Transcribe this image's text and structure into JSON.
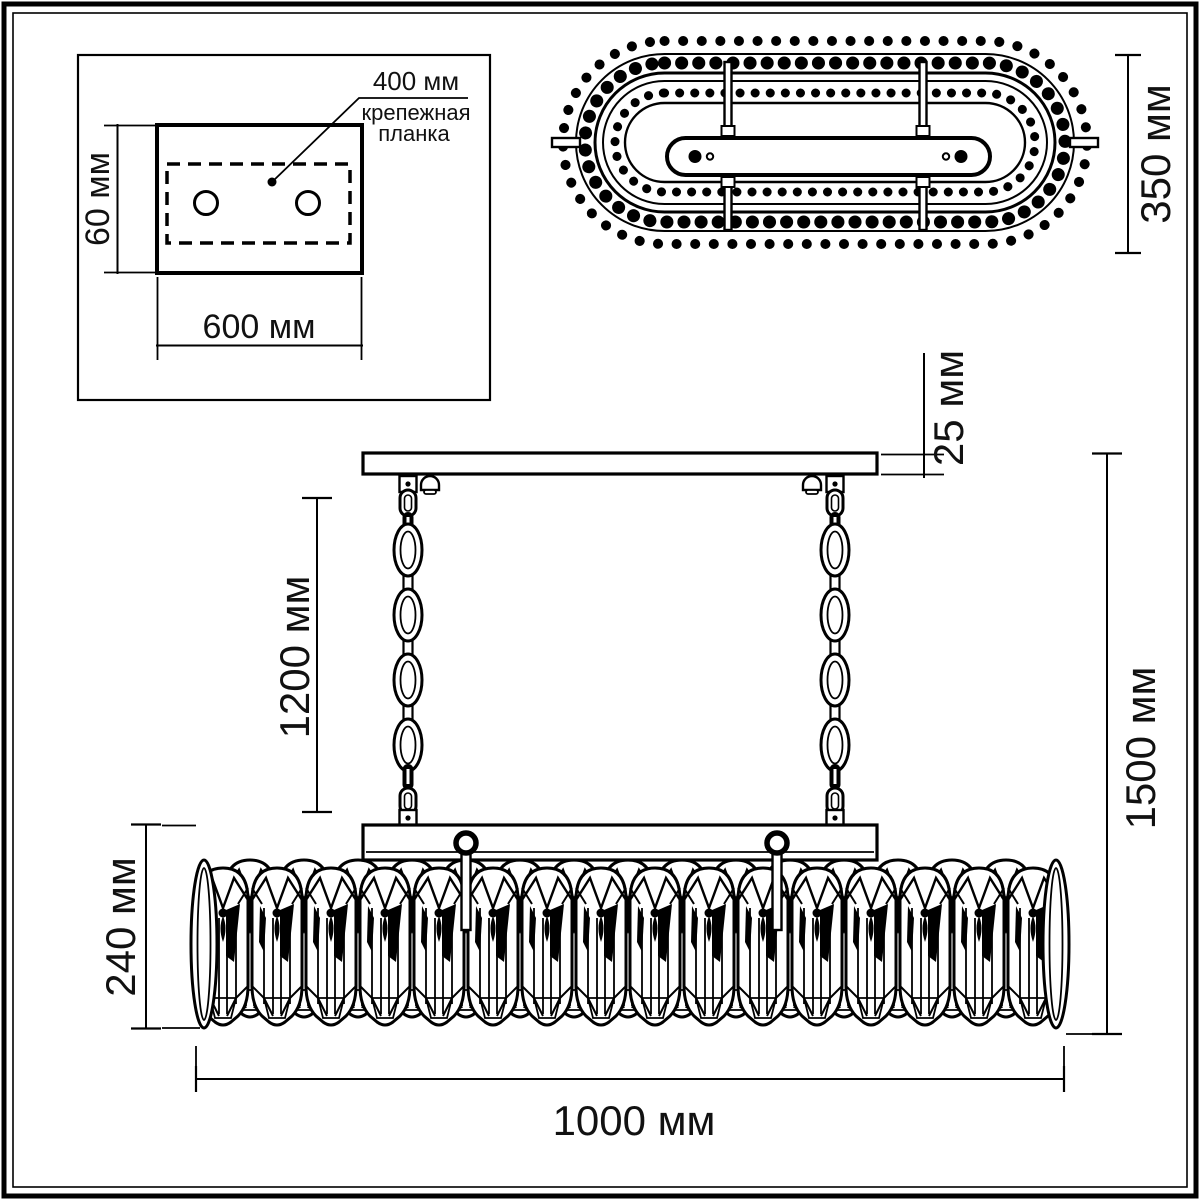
{
  "colors": {
    "line": "#000000",
    "background": "#ffffff"
  },
  "mounting_plate_view": {
    "width_dim": "600 мм",
    "height_dim": "60 мм",
    "bracket_dim": "400 мм",
    "bracket_label_line1": "крепежная",
    "bracket_label_line2": "планка"
  },
  "top_view": {
    "depth_dim": "350 мм"
  },
  "front_view": {
    "canopy_thickness_dim": "25 мм",
    "chain_length_dim": "1200 мм",
    "overall_height_dim": "1500 мм",
    "body_height_dim": "240 мм",
    "overall_width_dim": "1000 мм"
  }
}
